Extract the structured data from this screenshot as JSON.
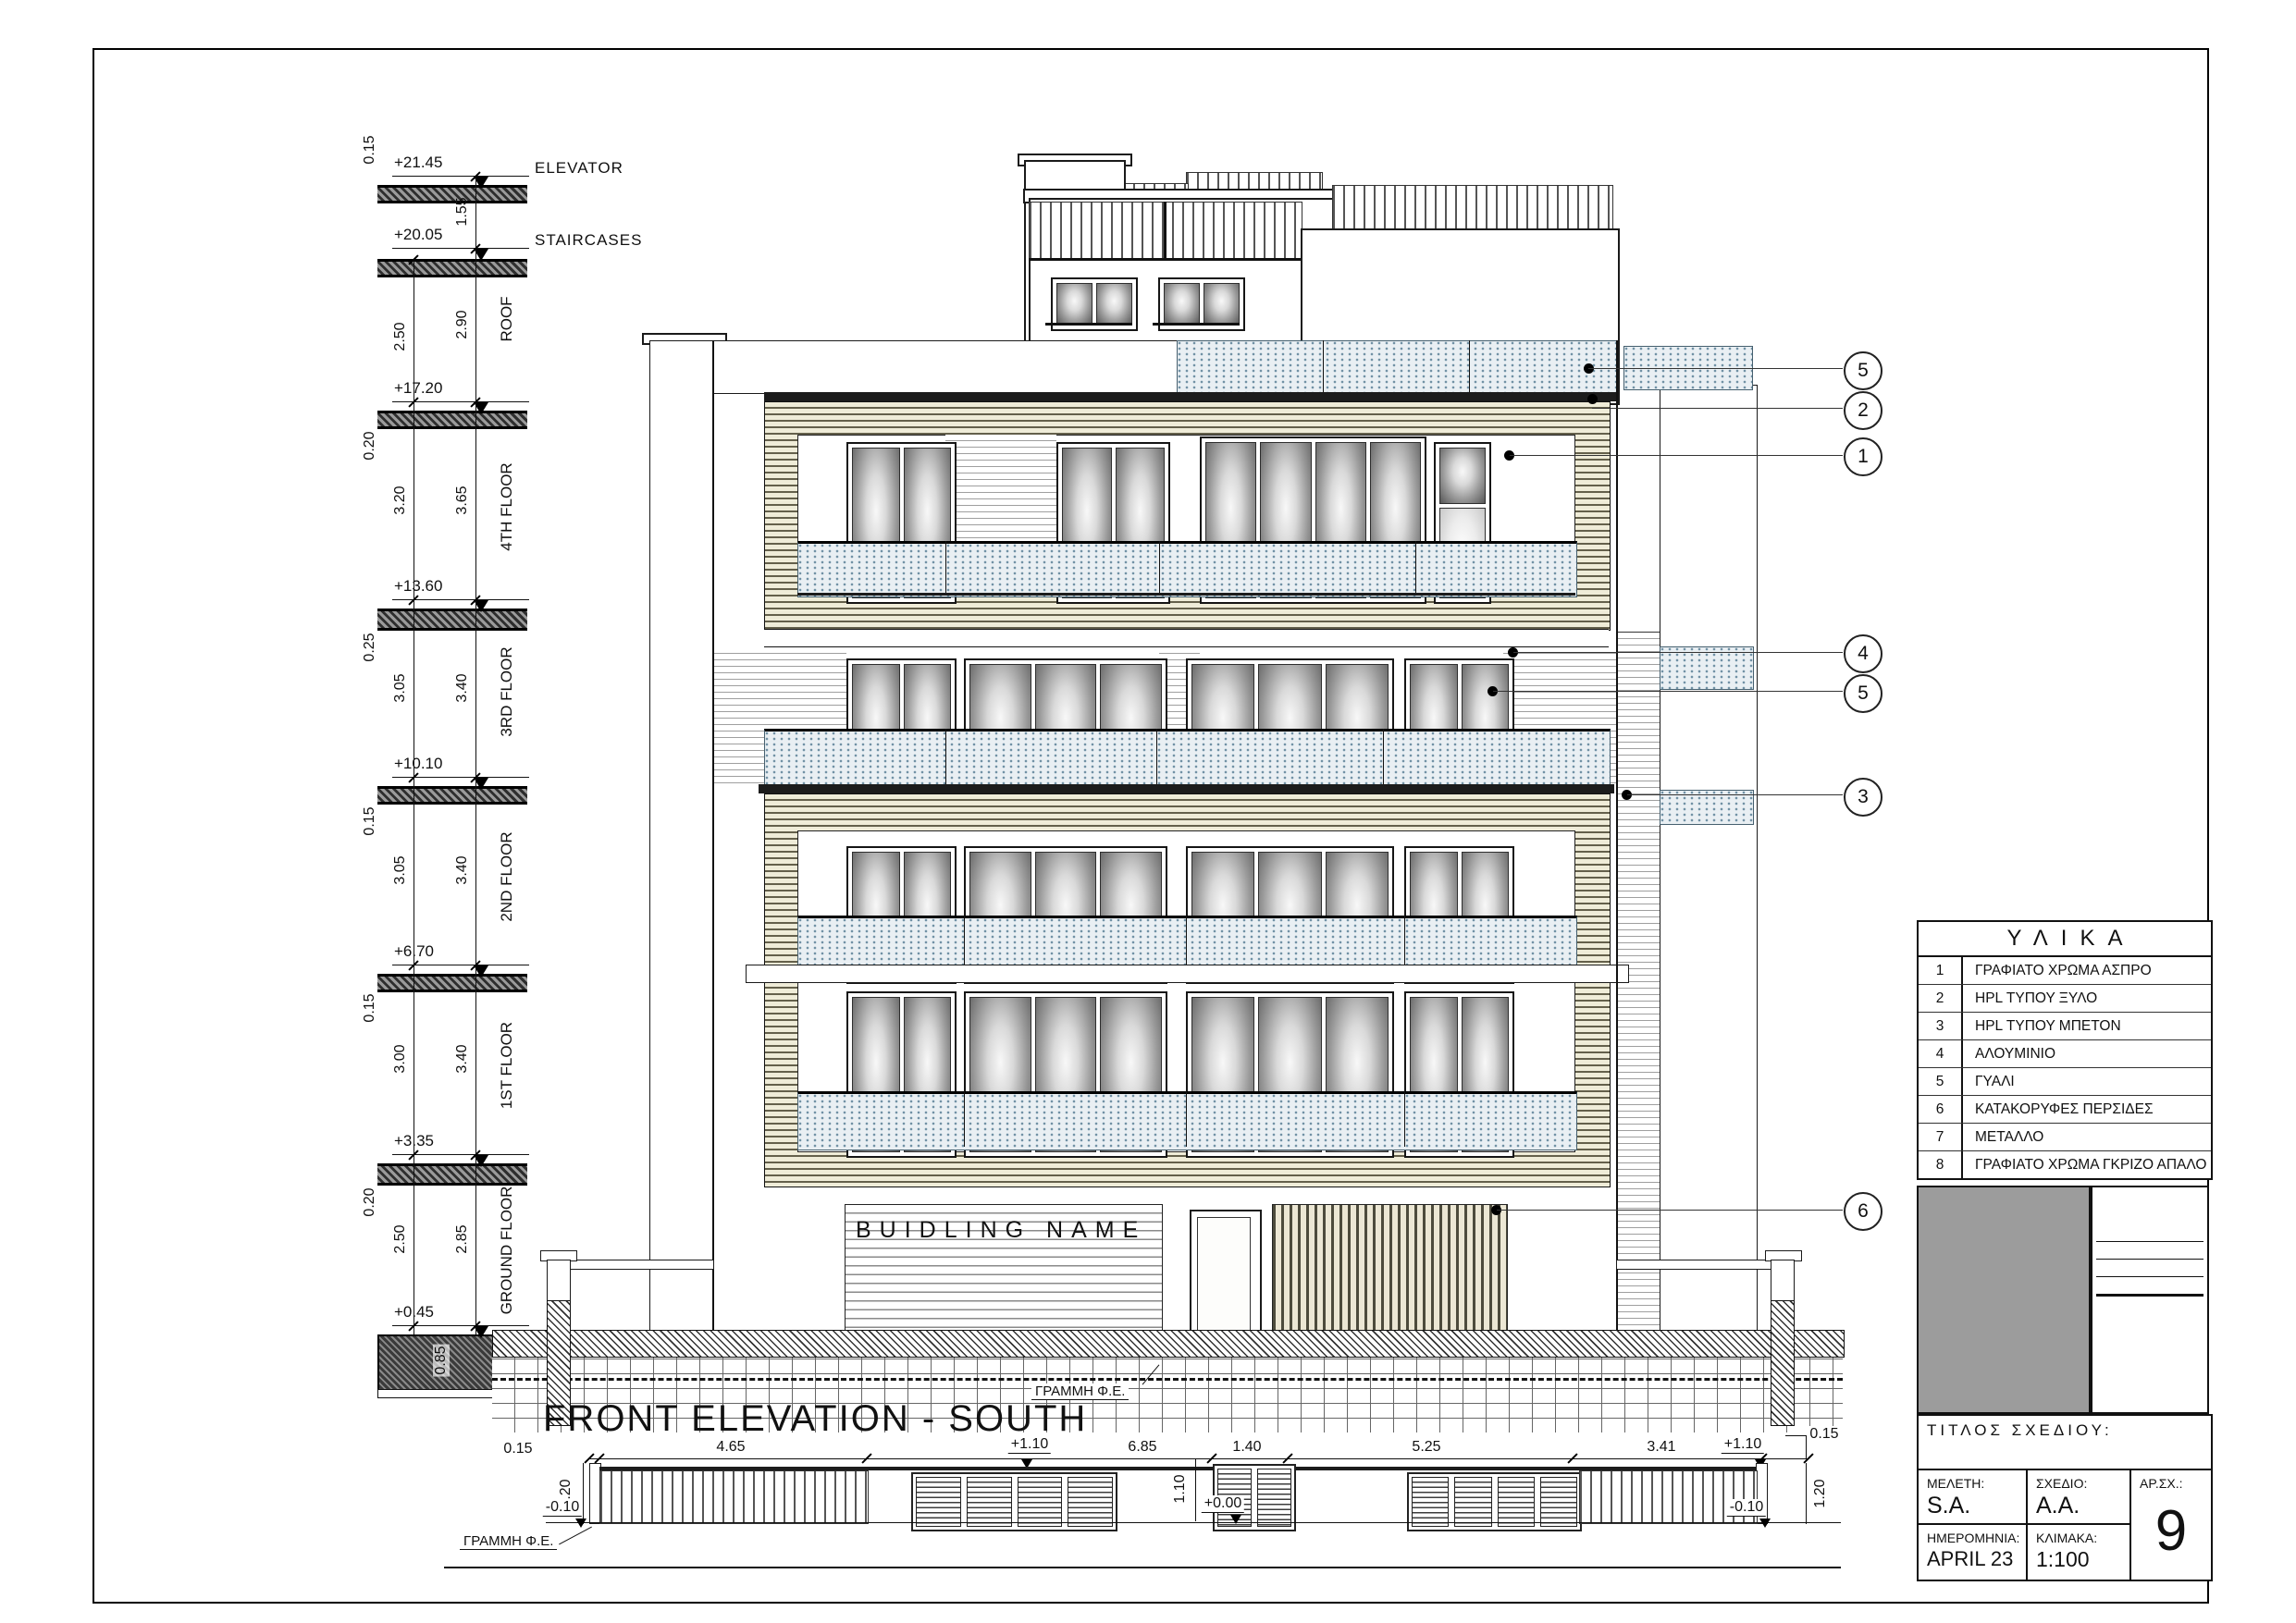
{
  "levels": [
    {
      "elev": "+21.45",
      "name": "ELEVATOR"
    },
    {
      "elev": "+20.05",
      "name": "STAIRCASES"
    },
    {
      "elev": "+17.20",
      "name": "ROOF"
    },
    {
      "elev": "+13.60",
      "name": "4TH FLOOR"
    },
    {
      "elev": "+10.10",
      "name": "3RD FLOOR"
    },
    {
      "elev": "+6.70",
      "name": "2ND FLOOR"
    },
    {
      "elev": "+3.35",
      "name": "1ST FLOOR"
    },
    {
      "elev": "+0.45",
      "name": "GROUND FLOOR"
    }
  ],
  "dim_chain_inner": [
    "2.50",
    "3.20",
    "3.05",
    "3.05",
    "3.00",
    "2.50"
  ],
  "dim_chain_outer": [
    "1.55",
    "2.90",
    "3.65",
    "3.40",
    "3.40",
    "3.40",
    "2.85"
  ],
  "slab_dims": {
    "elevator": "0.15",
    "roof": "0.20",
    "fourth": "0.25",
    "third": "0.15",
    "second": "0.15",
    "first": "0.20",
    "ground": "0.85"
  },
  "building": {
    "name_sign": "BUIDLING NAME"
  },
  "site": {
    "ground_line_label": "ΓΡΑΜΜΗ Φ.Ε."
  },
  "callouts": [
    {
      "n": "5"
    },
    {
      "n": "2"
    },
    {
      "n": "1"
    },
    {
      "n": "4"
    },
    {
      "n": "5"
    },
    {
      "n": "3"
    },
    {
      "n": "6"
    }
  ],
  "materials": {
    "title": "ΥΛΙΚΑ",
    "rows": [
      {
        "num": "1",
        "label": "ΓΡΑΦΙΑΤΟ ΧΡΩΜΑ ΑΣΠΡΟ"
      },
      {
        "num": "2",
        "label": "HPL ΤΥΠΟΥ ΞΥΛΟ"
      },
      {
        "num": "3",
        "label": "HPL ΤΥΠΟΥ ΜΠΕΤΟΝ"
      },
      {
        "num": "4",
        "label": "ΑΛΟΥΜΙΝΙΟ"
      },
      {
        "num": "5",
        "label": "ΓΥΑΛΙ"
      },
      {
        "num": "6",
        "label": "ΚΑΤΑΚΟΡΥΦΕΣ ΠΕΡΣΙΔΕΣ"
      },
      {
        "num": "7",
        "label": "ΜΕΤΑΛΛΟ"
      },
      {
        "num": "8",
        "label": "ΓΡΑΦΙΑΤΟ ΧΡΩΜΑ ΓΚΡΙΖΟ ΑΠΑΛΟ"
      }
    ]
  },
  "title_block": {
    "drawing_title_label": "ΤΙΤΛΟΣ ΣΧΕΔΙΟΥ:",
    "study_label": "ΜΕΛΕΤΗ:",
    "study": "S.A.",
    "drawn_label": "ΣΧΕΔΙΟ:",
    "drawn": "A.A.",
    "date_label": "ΗΜΕΡΟΜΗΝΙΑ:",
    "date": "APRIL 23",
    "scale_label": "ΚΛΙΜΑΚΑ:",
    "scale": "1:100",
    "sheet_label": "ΑΡ.ΣΧ.:",
    "sheet": "9"
  },
  "elevation_title": "FRONT ELEVATION - SOUTH",
  "bottom_detail": {
    "h_dims": [
      "0.15",
      "4.65",
      "6.85",
      "1.40",
      "5.25",
      "3.41"
    ],
    "lvl_plus110_a": "+1.10",
    "lvl_plus110_b": "+1.10",
    "lvl_zero": "+0.00",
    "lvl_minus010_a": "-0.10",
    "lvl_minus010_b": "-0.10",
    "v_dim_left": "1.20",
    "v_dim_mid": "1.10",
    "v_dim_right": "1.20",
    "top_right": "0.15",
    "ground_line_label": "ΓΡΑΜΜΗ Φ.Ε."
  }
}
